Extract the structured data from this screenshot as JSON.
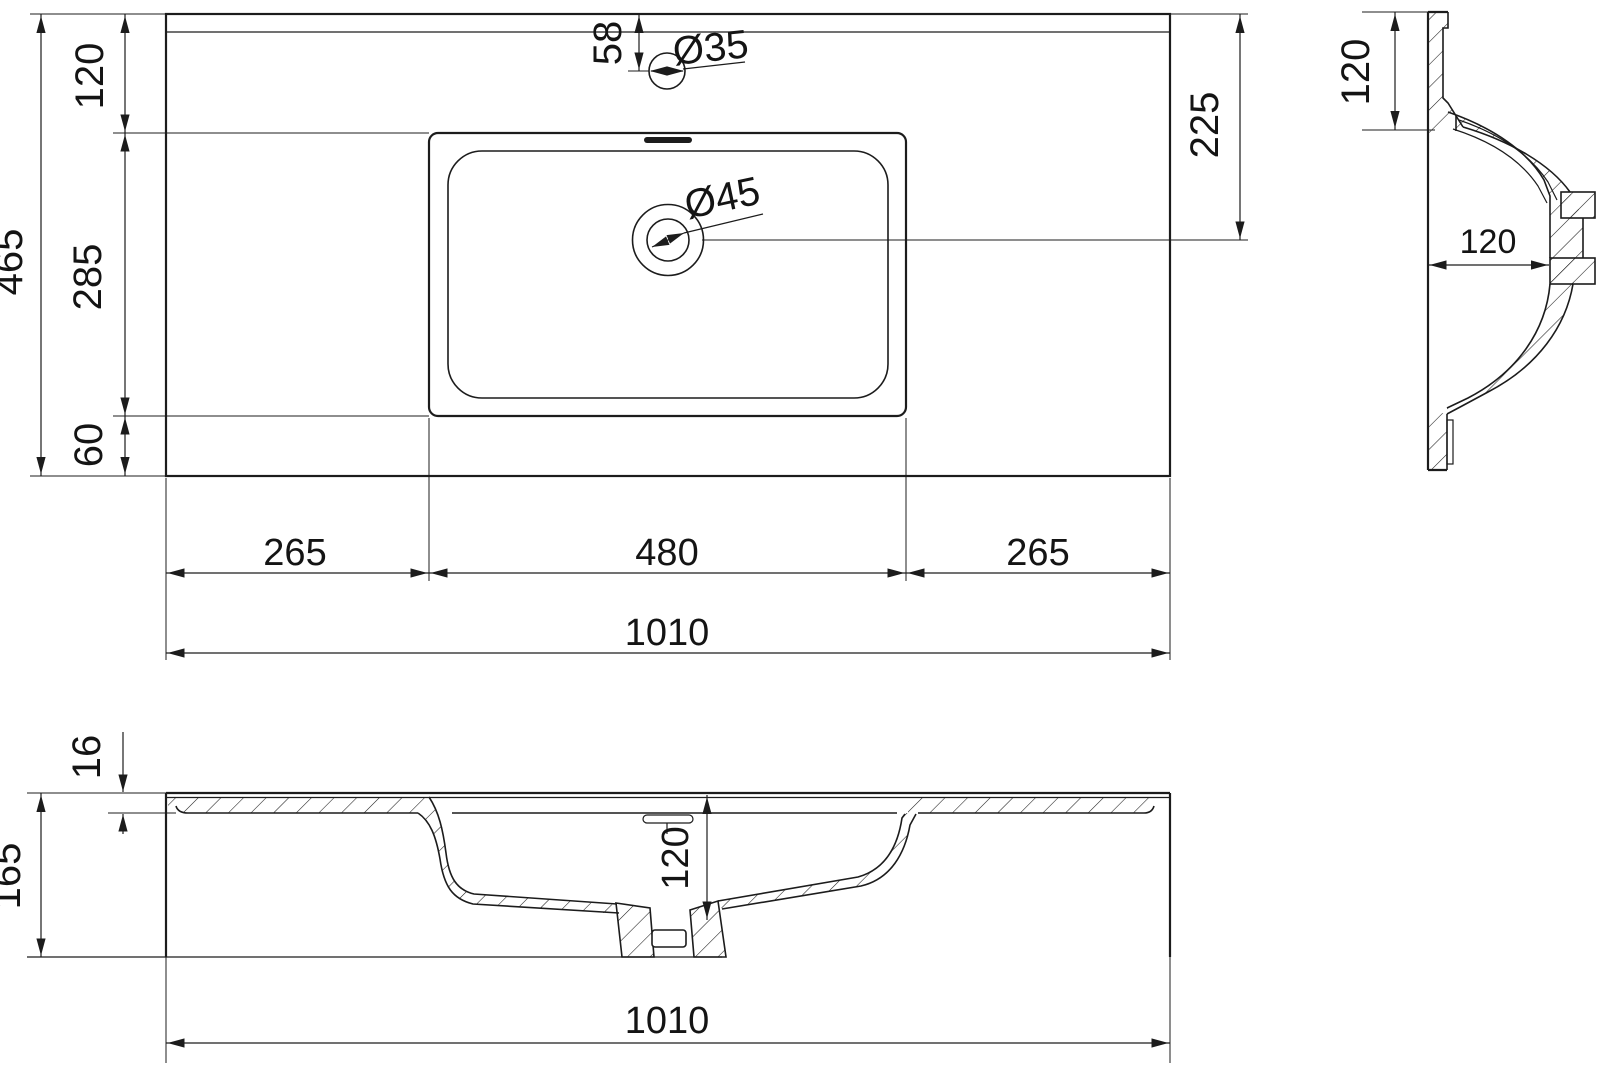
{
  "drawing": {
    "kind": "washbasin technical drawing",
    "units": "mm",
    "line_color": "#1c1c1c",
    "background": "#ffffff"
  },
  "top_view": {
    "overall_depth": "465",
    "back_to_basin": "120",
    "basin_plan_depth": "285",
    "basin_to_front": "60",
    "faucet_offset": "58",
    "faucet_hole_dia": "Ø35",
    "drain_dia": "Ø45",
    "drain_from_back": "225",
    "left_margin": "265",
    "basin_width": "480",
    "right_margin": "265",
    "overall_width": "1010"
  },
  "side_view": {
    "back_ledge": "120",
    "bowl_depth": "120"
  },
  "front_view": {
    "slab_thickness": "16",
    "overall_height": "165",
    "bowl_depth": "120",
    "overall_width": "1010"
  }
}
